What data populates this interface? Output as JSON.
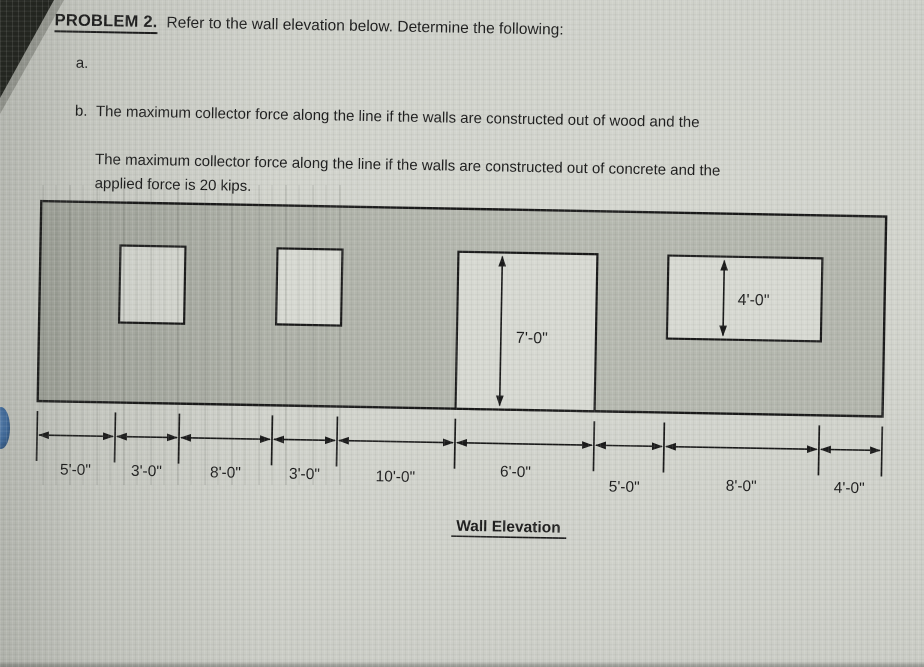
{
  "colors": {
    "photo-bg": "#cfd1ca",
    "wall-fill": "#b2b5ac",
    "opening-fill": "#d7d9d2",
    "line": "#1a1a1a",
    "text": "#1c1c1c",
    "accent-blue": "#3f6fa8"
  },
  "problem": {
    "heading": "PROBLEM 2.",
    "intro": "Refer to the wall elevation below.  Determine the following:",
    "items": [
      {
        "marker": "a.",
        "lines": [
          "The maximum collector force along the line if the walls are constructed out of wood and the",
          "applied force is 20 kips."
        ]
      },
      {
        "marker": "b.",
        "lines": [
          "The maximum collector force along the line if the walls are constructed out of concrete and the",
          "applied load is 60 kips.  Assume the walls are fixed at the base."
        ]
      }
    ]
  },
  "diagram": {
    "caption": "Wall Elevation",
    "h_dims": [
      "5'-0\"",
      "3'-0\"",
      "8'-0\"",
      "3'-0\"",
      "10'-0\"",
      "6'-0\"",
      "5'-0\"",
      "8'-0\"",
      "4'-0\""
    ],
    "v_dims": {
      "door": "7'-0\"",
      "window": "4'-0\""
    }
  }
}
